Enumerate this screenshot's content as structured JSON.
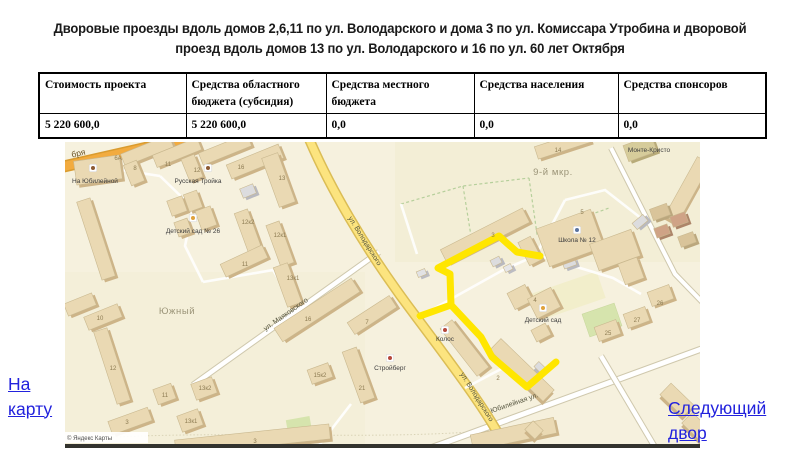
{
  "title": "Дворовые проезды вдоль домов 2,6,11 по ул. Володарского и дома 3 по ул. Комиссара Утробина и дворовой проезд вдоль домов 13 по ул. Володарского и 16 по ул. 60 лет Октября",
  "table": {
    "headers": [
      "Стоимость проекта",
      "Средства областного бюджета (субсидия)",
      "Средства местного бюджета",
      "Средства населения",
      "Средства спонсоров"
    ],
    "row": [
      "5 220 600,0",
      "5 220 600,0",
      "0,0",
      "0,0",
      "0,0"
    ]
  },
  "links": {
    "map_link": "На карту",
    "next_link": "Следующий двор"
  },
  "map": {
    "attribution": "© Яндекс Карты",
    "route": {
      "color": "#ffe600",
      "width": 7,
      "main": [
        [
          475,
          114
        ],
        [
          452,
          110
        ],
        [
          434,
          94
        ],
        [
          373,
          126
        ],
        [
          385,
          132
        ],
        [
          386,
          163
        ],
        [
          416,
          195
        ],
        [
          427,
          215
        ],
        [
          462,
          245
        ],
        [
          491,
          220
        ]
      ],
      "branch": [
        [
          386,
          163
        ],
        [
          355,
          174
        ]
      ]
    },
    "labels": [
      {
        "t": "бря",
        "x": 14,
        "y": 14,
        "c": "road",
        "r": -13
      },
      {
        "t": "ул. Володарского",
        "x": 298,
        "y": 100,
        "c": "street",
        "r": 58
      },
      {
        "t": "ул. Володарского",
        "x": 410,
        "y": 256,
        "c": "street",
        "r": 58
      },
      {
        "t": "ул. Маяковского",
        "x": 222,
        "y": 174,
        "c": "street",
        "r": -35
      },
      {
        "t": "Юбилейная ул.",
        "x": 450,
        "y": 263,
        "c": "street",
        "r": -19
      },
      {
        "t": "Южный",
        "x": 112,
        "y": 172,
        "c": "district"
      },
      {
        "t": "9-й мкр.",
        "x": 488,
        "y": 33,
        "c": "district"
      },
      {
        "t": "На Юбилейной",
        "x": 30,
        "y": 41,
        "c": "poi"
      },
      {
        "t": "Русская Тройка",
        "x": 133,
        "y": 41,
        "c": "poi"
      },
      {
        "t": "Детский сад № 26",
        "x": 128,
        "y": 91,
        "c": "poi"
      },
      {
        "t": "Школа № 12",
        "x": 512,
        "y": 100,
        "c": "poi"
      },
      {
        "t": "Детский сад",
        "x": 478,
        "y": 180,
        "c": "poi"
      },
      {
        "t": "Колос",
        "x": 380,
        "y": 199,
        "c": "poi"
      },
      {
        "t": "Стройберг",
        "x": 325,
        "y": 228,
        "c": "poi"
      },
      {
        "t": "Монте-Кристо",
        "x": 584,
        "y": 10,
        "c": "poi"
      },
      {
        "t": "6А",
        "x": 53,
        "y": 18,
        "c": "num"
      },
      {
        "t": "8",
        "x": 70,
        "y": 28,
        "c": "num"
      },
      {
        "t": "11",
        "x": 103,
        "y": 24,
        "c": "num"
      },
      {
        "t": "12",
        "x": 132,
        "y": 30,
        "c": "num"
      },
      {
        "t": "16",
        "x": 176,
        "y": 27,
        "c": "num"
      },
      {
        "t": "13",
        "x": 217,
        "y": 38,
        "c": "num"
      },
      {
        "t": "14",
        "x": 493,
        "y": 10,
        "c": "num"
      },
      {
        "t": "12к2",
        "x": 183,
        "y": 82,
        "c": "num"
      },
      {
        "t": "12к1",
        "x": 215,
        "y": 95,
        "c": "num"
      },
      {
        "t": "11",
        "x": 180,
        "y": 124,
        "c": "num"
      },
      {
        "t": "13к1",
        "x": 228,
        "y": 138,
        "c": "num"
      },
      {
        "t": "5",
        "x": 517,
        "y": 72,
        "c": "num"
      },
      {
        "t": "3",
        "x": 428,
        "y": 95,
        "c": "num"
      },
      {
        "t": "4",
        "x": 470,
        "y": 160,
        "c": "num"
      },
      {
        "t": "2",
        "x": 433,
        "y": 238,
        "c": "num"
      },
      {
        "t": "10",
        "x": 35,
        "y": 178,
        "c": "num"
      },
      {
        "t": "12",
        "x": 48,
        "y": 228,
        "c": "num"
      },
      {
        "t": "13к2",
        "x": 140,
        "y": 248,
        "c": "num"
      },
      {
        "t": "13к1",
        "x": 126,
        "y": 281,
        "c": "num"
      },
      {
        "t": "11",
        "x": 100,
        "y": 255,
        "c": "num"
      },
      {
        "t": "3",
        "x": 62,
        "y": 282,
        "c": "num"
      },
      {
        "t": "16",
        "x": 243,
        "y": 179,
        "c": "num"
      },
      {
        "t": "7",
        "x": 302,
        "y": 182,
        "c": "num"
      },
      {
        "t": "21",
        "x": 297,
        "y": 248,
        "c": "num"
      },
      {
        "t": "15к2",
        "x": 255,
        "y": 235,
        "c": "num"
      },
      {
        "t": "26",
        "x": 595,
        "y": 163,
        "c": "num"
      },
      {
        "t": "27",
        "x": 572,
        "y": 180,
        "c": "num"
      },
      {
        "t": "25",
        "x": 543,
        "y": 193,
        "c": "num"
      },
      {
        "t": "3",
        "x": 190,
        "y": 301,
        "c": "num"
      }
    ],
    "pois": [
      {
        "x": 28,
        "y": 26,
        "k": "cafe"
      },
      {
        "x": 143,
        "y": 26,
        "k": "cafe"
      },
      {
        "x": 128,
        "y": 76,
        "k": "kindergarten"
      },
      {
        "x": 512,
        "y": 88,
        "k": "school"
      },
      {
        "x": 478,
        "y": 166,
        "k": "kindergarten"
      },
      {
        "x": 380,
        "y": 188,
        "k": "shop"
      },
      {
        "x": 325,
        "y": 216,
        "k": "shop"
      }
    ],
    "poi_colors": {
      "cafe": "#8d5a33",
      "kindergarten": "#e0a23c",
      "school": "#5b74a0",
      "shop": "#b5483a"
    },
    "buildings": [
      {
        "x": 10,
        "y": 16,
        "w": 46,
        "h": 24,
        "r": -8
      },
      {
        "x": 56,
        "y": 2,
        "w": 52,
        "h": 13,
        "r": -22
      },
      {
        "x": 62,
        "y": 20,
        "w": 14,
        "h": 22,
        "r": -22
      },
      {
        "x": 88,
        "y": 4,
        "w": 48,
        "h": 13,
        "r": -22
      },
      {
        "x": 120,
        "y": 14,
        "w": 14,
        "h": 24,
        "r": -22
      },
      {
        "x": 134,
        "y": 1,
        "w": 52,
        "h": 13,
        "r": -22
      },
      {
        "x": 162,
        "y": 12,
        "w": 56,
        "h": 15,
        "r": -22
      },
      {
        "x": 205,
        "y": 12,
        "w": 17,
        "h": 52,
        "r": -20
      },
      {
        "x": 470,
        "y": -4,
        "w": 55,
        "h": 13,
        "r": -18
      },
      {
        "x": 560,
        "y": -2,
        "w": 30,
        "h": 17,
        "r": -20,
        "f": "#d6cc9b",
        "e": "#b8ab79"
      },
      {
        "x": 615,
        "y": 14,
        "w": 15,
        "h": 68,
        "r": 29
      },
      {
        "x": 24,
        "y": 56,
        "w": 14,
        "h": 82,
        "r": -18
      },
      {
        "x": 104,
        "y": 56,
        "w": 16,
        "h": 16,
        "r": -20
      },
      {
        "x": 121,
        "y": 50,
        "w": 14,
        "h": 18,
        "r": -20
      },
      {
        "x": 133,
        "y": 66,
        "w": 16,
        "h": 20,
        "r": -20
      },
      {
        "x": 111,
        "y": 78,
        "w": 14,
        "h": 15,
        "r": -20
      },
      {
        "x": 176,
        "y": 68,
        "w": 14,
        "h": 42,
        "r": -20
      },
      {
        "x": 208,
        "y": 80,
        "w": 14,
        "h": 44,
        "r": -20
      },
      {
        "x": 156,
        "y": 112,
        "w": 46,
        "h": 14,
        "r": -25
      },
      {
        "x": 215,
        "y": 122,
        "w": 15,
        "h": 42,
        "r": -20
      },
      {
        "x": 176,
        "y": 44,
        "w": 14,
        "h": 10,
        "r": -22,
        "f": "#dcdcde",
        "e": "#b9b9bf"
      },
      {
        "x": 426,
        "y": 116,
        "w": 10,
        "h": 7,
        "r": -27,
        "f": "#dcdcde",
        "e": "#b9b9bf"
      },
      {
        "x": 439,
        "y": 123,
        "w": 8,
        "h": 6,
        "r": -27,
        "f": "#e6e6e8",
        "e": "#bcbcc2"
      },
      {
        "x": 498,
        "y": 118,
        "w": 13,
        "h": 7,
        "r": -20,
        "f": "#dcdcde",
        "e": "#b9b9bf"
      },
      {
        "x": 568,
        "y": 76,
        "w": 14,
        "h": 8,
        "r": -40,
        "f": "#dcdcde",
        "e": "#b9b9bf"
      },
      {
        "x": 352,
        "y": 128,
        "w": 9,
        "h": 6,
        "r": -22,
        "f": "#e2e2e4",
        "e": "#bcbcc2"
      },
      {
        "x": 470,
        "y": 222,
        "w": 10,
        "h": 7,
        "r": 44,
        "f": "#dcdcde",
        "e": "#b9b9bf"
      },
      {
        "x": 476,
        "y": 76,
        "w": 58,
        "h": 40,
        "r": -20
      },
      {
        "x": 528,
        "y": 94,
        "w": 44,
        "h": 28,
        "r": -20
      },
      {
        "x": 556,
        "y": 118,
        "w": 20,
        "h": 22,
        "r": -20
      },
      {
        "x": 374,
        "y": 86,
        "w": 92,
        "h": 16,
        "r": -27
      },
      {
        "x": 458,
        "y": 96,
        "w": 14,
        "h": 26,
        "r": -27
      },
      {
        "x": 392,
        "y": 176,
        "w": 15,
        "h": 60,
        "r": -38
      },
      {
        "x": 420,
        "y": 220,
        "w": 74,
        "h": 16,
        "r": 44
      },
      {
        "x": 445,
        "y": 146,
        "w": 20,
        "h": 18,
        "r": -27
      },
      {
        "x": 466,
        "y": 150,
        "w": 26,
        "h": 22,
        "r": -27
      },
      {
        "x": 468,
        "y": 184,
        "w": 16,
        "h": 13,
        "r": -27
      },
      {
        "x": 0,
        "y": 156,
        "w": 30,
        "h": 13,
        "r": -22
      },
      {
        "x": 20,
        "y": 168,
        "w": 36,
        "h": 14,
        "r": -22
      },
      {
        "x": 40,
        "y": 186,
        "w": 14,
        "h": 76,
        "r": -18
      },
      {
        "x": 128,
        "y": 238,
        "w": 22,
        "h": 17,
        "r": -20
      },
      {
        "x": 114,
        "y": 270,
        "w": 22,
        "h": 17,
        "r": -20
      },
      {
        "x": 90,
        "y": 244,
        "w": 19,
        "h": 16,
        "r": -20
      },
      {
        "x": 44,
        "y": 272,
        "w": 42,
        "h": 14,
        "r": -20
      },
      {
        "x": 110,
        "y": 290,
        "w": 155,
        "h": 15,
        "r": -6
      },
      {
        "x": 206,
        "y": 160,
        "w": 92,
        "h": 16,
        "r": -33
      },
      {
        "x": 282,
        "y": 166,
        "w": 50,
        "h": 14,
        "r": -33
      },
      {
        "x": 286,
        "y": 206,
        "w": 15,
        "h": 54,
        "r": -20
      },
      {
        "x": 244,
        "y": 224,
        "w": 22,
        "h": 15,
        "r": -20
      },
      {
        "x": 406,
        "y": 284,
        "w": 85,
        "h": 16,
        "r": -12
      },
      {
        "x": 586,
        "y": 64,
        "w": 18,
        "h": 12,
        "r": -20,
        "f": "#d9c49a",
        "e": "#bba77d"
      },
      {
        "x": 606,
        "y": 72,
        "w": 16,
        "h": 11,
        "r": -20,
        "f": "#cfa386",
        "e": "#ad8569"
      },
      {
        "x": 590,
        "y": 84,
        "w": 14,
        "h": 10,
        "r": -20,
        "f": "#cfa386",
        "e": "#ad8569"
      },
      {
        "x": 614,
        "y": 92,
        "w": 16,
        "h": 11,
        "r": -20,
        "f": "#d9c49a",
        "e": "#bba77d"
      },
      {
        "x": 584,
        "y": 146,
        "w": 23,
        "h": 15,
        "r": -20
      },
      {
        "x": 560,
        "y": 168,
        "w": 23,
        "h": 15,
        "r": -20
      },
      {
        "x": 531,
        "y": 181,
        "w": 23,
        "h": 15,
        "r": -20
      },
      {
        "x": 596,
        "y": 250,
        "w": 32,
        "h": 16,
        "r": 44
      },
      {
        "x": 618,
        "y": 278,
        "w": 28,
        "h": 15,
        "r": 44
      },
      {
        "x": 462,
        "y": 282,
        "w": 14,
        "h": 12,
        "r": 44
      }
    ]
  }
}
